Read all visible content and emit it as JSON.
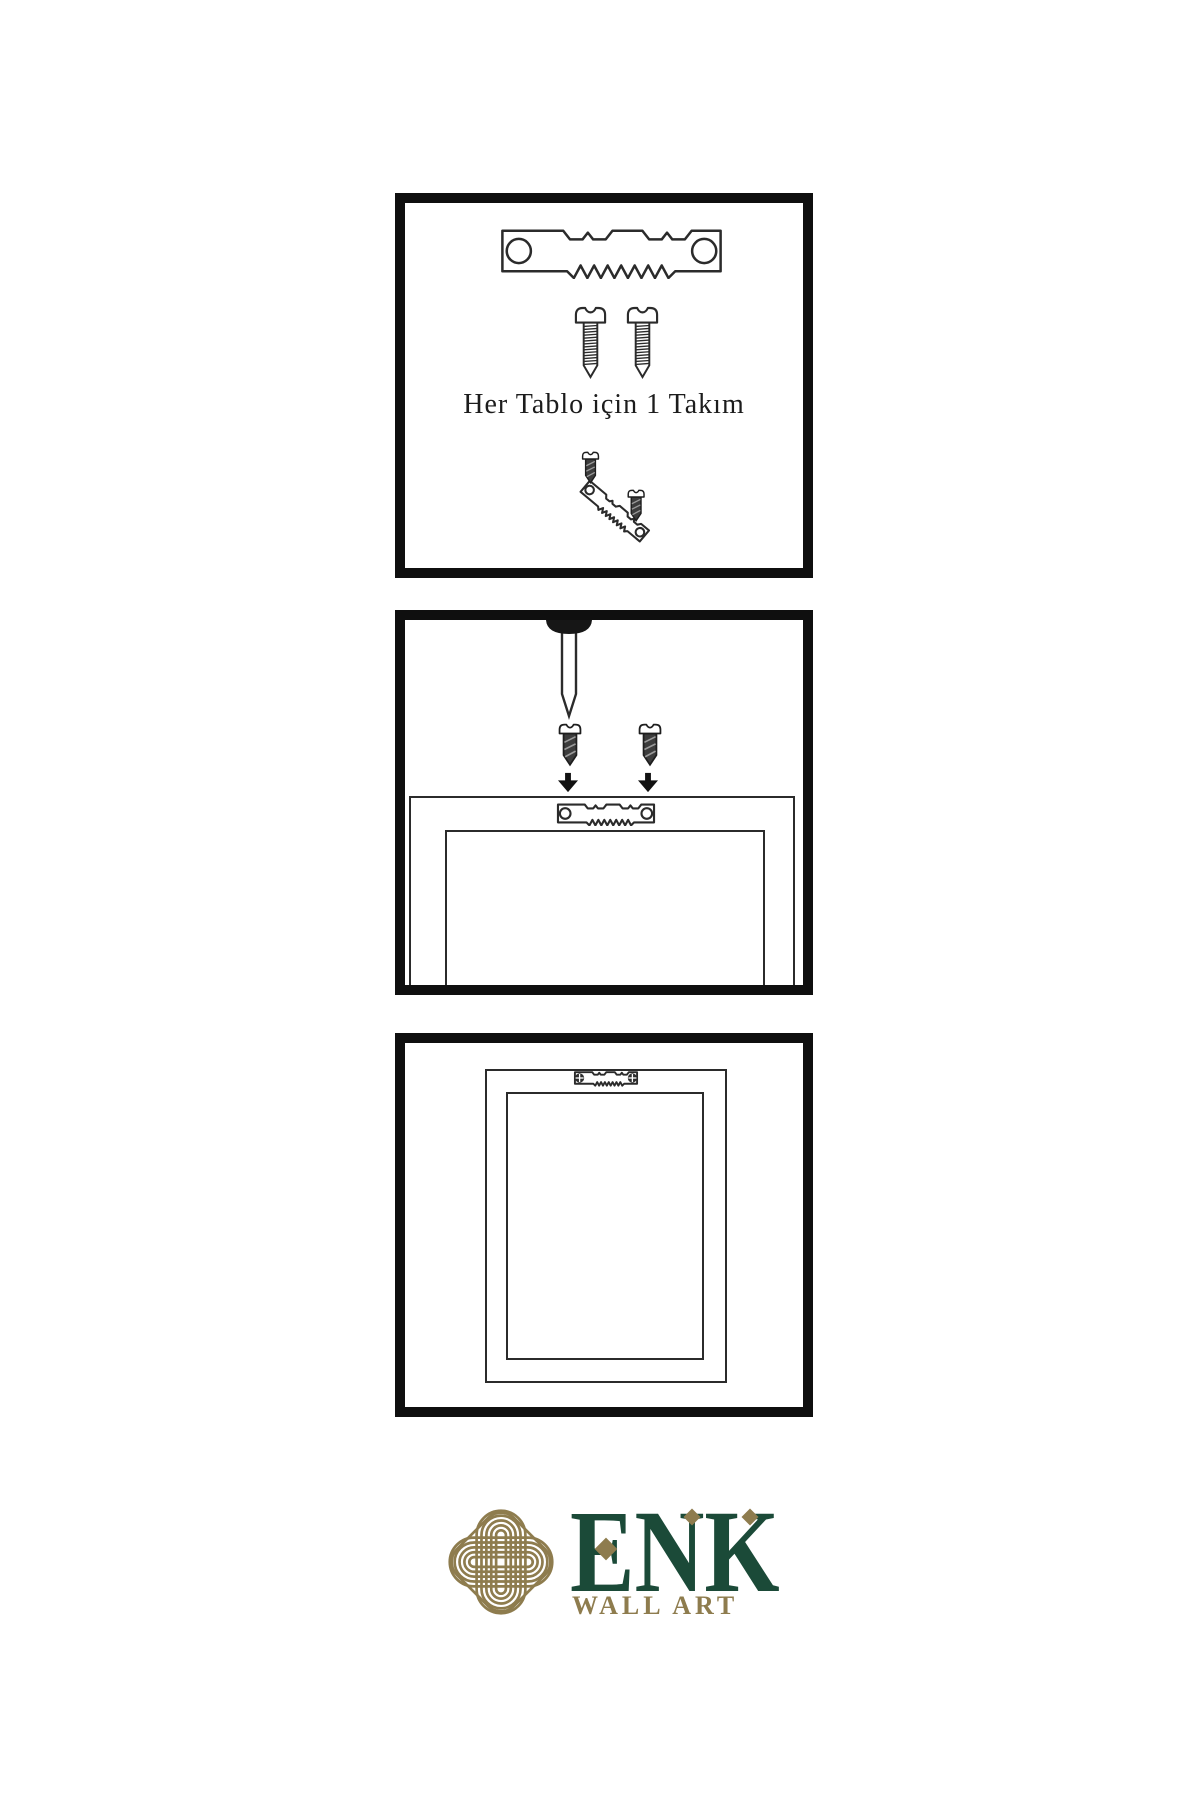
{
  "document": {
    "type": "wall-art-hanging-instructions",
    "language": "Turkish"
  },
  "steps": [
    {
      "name": "hardware-kit",
      "caption": "Her Tablo için 1 Takım",
      "items": [
        "sawtooth-hanger",
        "screw",
        "screw",
        "tilted-hanger-with-screws"
      ]
    },
    {
      "name": "attach-hanger-to-frame",
      "items": [
        "wall-nail",
        "screw-with-down-arrow",
        "screw-with-down-arrow",
        "frame-back",
        "sawtooth-hanger-attached"
      ]
    },
    {
      "name": "frame-hung-on-wall",
      "items": [
        "frame-with-mounted-hanger"
      ]
    }
  ],
  "brand": {
    "name": "ENK",
    "tagline": "WALL ART"
  },
  "icons": {
    "sawtooth-hanger": "metal sawtooth picture hanger plate with two holes",
    "screw": "outlined pan-head screw",
    "dark-screw": "dark shaded screw",
    "down-arrow": "solid black down arrow",
    "wall-nail": "nail with dark head driven from top",
    "knot-logo": "interlaced gold guilloche knot in rounded diamond"
  },
  "colors": {
    "background": "#FFFFFF",
    "panel_border": "#0F0F0F",
    "line": "#2B2B2B",
    "dark_fill": "#3C3C3C",
    "brand_green": "#1B4A38",
    "accent_gold": "#8E7C4E"
  }
}
